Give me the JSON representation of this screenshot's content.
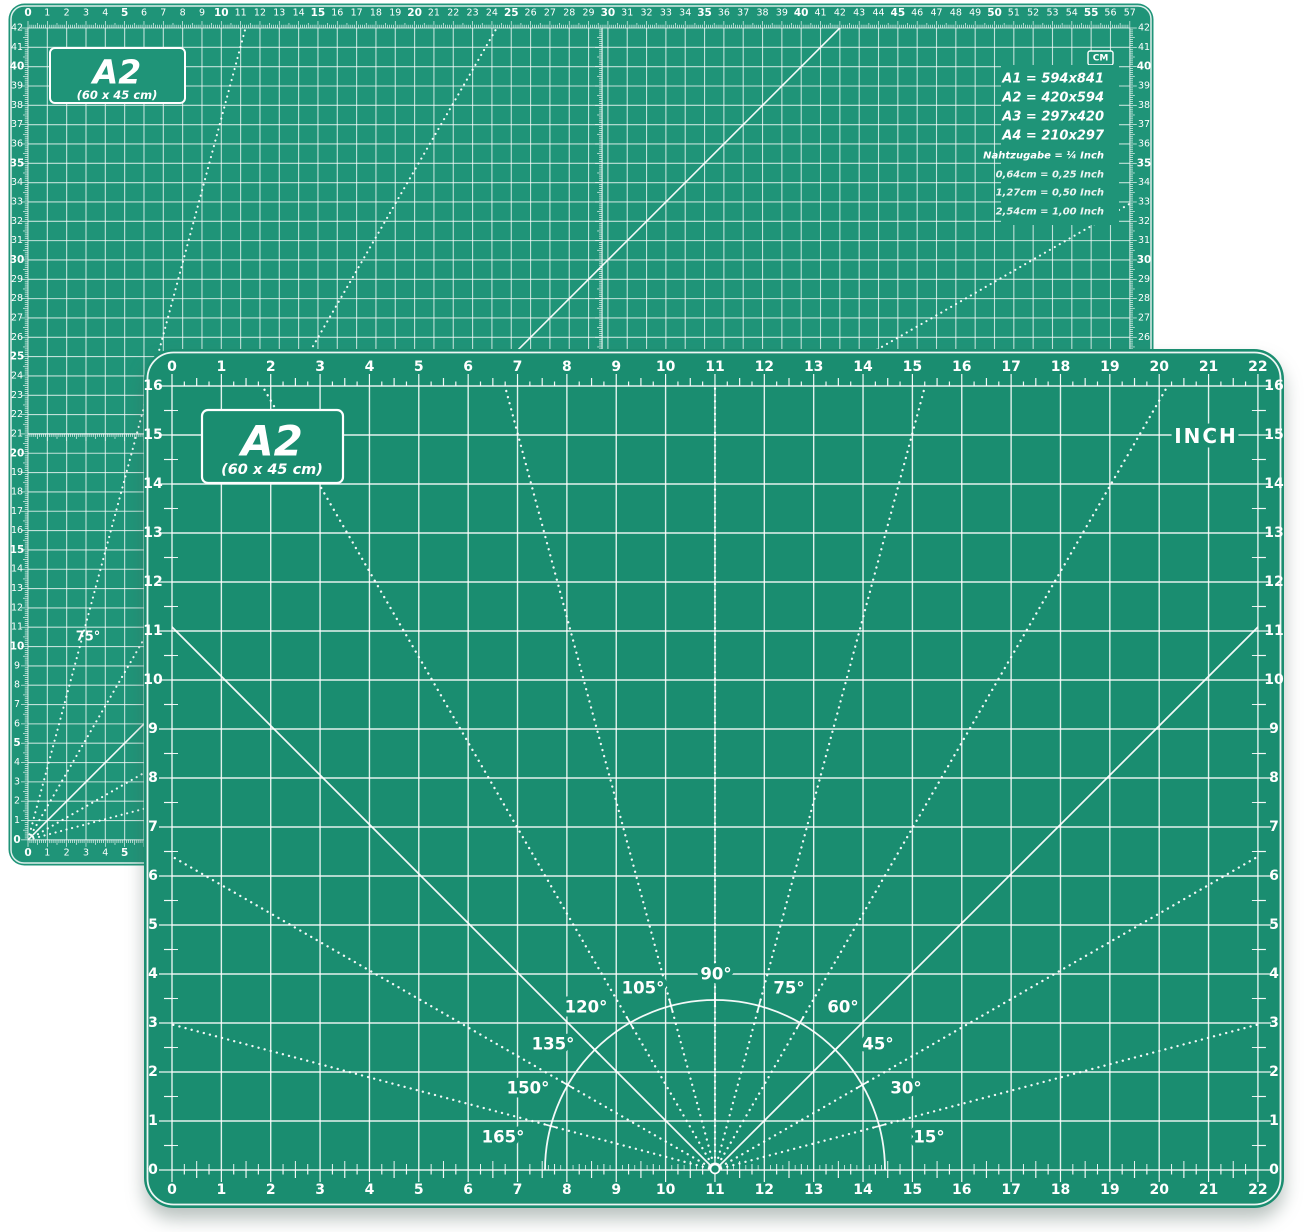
{
  "back_mat": {
    "title": "A2",
    "subtitle": "(60 x 45 cm)",
    "unit": "CM",
    "angle_label": "75°",
    "paper_sizes": [
      "A1 = 594x841",
      "A2 = 420x594",
      "A3 = 297x420",
      "A4 = 210x297"
    ],
    "seam_allowance": "Nahtzugabe = ¼ Inch",
    "conversions": [
      "0,64cm = 0,25 Inch",
      "1,27cm = 0,50 Inch",
      "2,54cm = 1,00 Inch"
    ],
    "top_numbers": [
      0,
      1,
      2,
      3,
      4,
      5,
      6,
      7,
      8,
      9,
      10,
      11,
      12,
      13,
      14,
      15,
      16,
      17,
      18,
      19,
      20,
      21,
      22,
      23,
      24,
      25,
      26,
      27,
      28,
      29,
      30,
      31,
      32,
      33,
      34,
      35,
      36,
      37,
      38,
      39,
      40,
      41,
      42,
      43,
      44,
      45,
      46,
      47,
      48,
      49,
      50,
      51,
      52,
      53,
      54,
      55,
      56,
      57
    ],
    "left_numbers": [
      42,
      41,
      40,
      39,
      38,
      37,
      36,
      35,
      34,
      33,
      32,
      31,
      30,
      29,
      28,
      27,
      26,
      25,
      24,
      23,
      22,
      21,
      20,
      19,
      18,
      17,
      16,
      15,
      14,
      13,
      12,
      11,
      10,
      9,
      8,
      7,
      6,
      5,
      4,
      3,
      2,
      1,
      0
    ],
    "right_numbers": [
      42,
      41,
      40,
      39,
      38,
      37,
      36,
      35,
      34,
      33,
      32,
      31,
      30,
      29,
      28,
      27,
      26
    ],
    "bottom_numbers": [
      0,
      1,
      2,
      3,
      4,
      5
    ]
  },
  "front_mat": {
    "title": "A2",
    "subtitle": "(60 x 45 cm)",
    "unit": "INCH",
    "angle_labels": [
      "90°",
      "105°",
      "75°",
      "120°",
      "60°",
      "135°",
      "45°",
      "150°",
      "30°",
      "165°",
      "15°"
    ],
    "top_numbers": [
      0,
      1,
      2,
      3,
      4,
      5,
      6,
      7,
      8,
      9,
      10,
      11,
      12,
      13,
      14,
      15,
      16,
      17,
      18,
      19,
      20,
      21,
      22
    ],
    "bottom_numbers": [
      0,
      1,
      2,
      3,
      4,
      5,
      6,
      7,
      8,
      9,
      10,
      11,
      12,
      13,
      14,
      15,
      16,
      17,
      18,
      19,
      20,
      21,
      22
    ],
    "left_numbers": [
      16,
      15,
      14,
      13,
      12,
      11,
      10,
      9,
      8,
      7,
      6,
      5,
      4,
      3,
      2,
      1,
      0
    ],
    "right_numbers": [
      16,
      15,
      14,
      13,
      12,
      11,
      10,
      9,
      8,
      7,
      6,
      5,
      4,
      3,
      2,
      1,
      0
    ]
  },
  "colors": {
    "back_mat_green": "#1f9478",
    "front_mat_green": "#1a8d70",
    "grid_line": "#ffffff",
    "page_background": "#ffffff"
  }
}
